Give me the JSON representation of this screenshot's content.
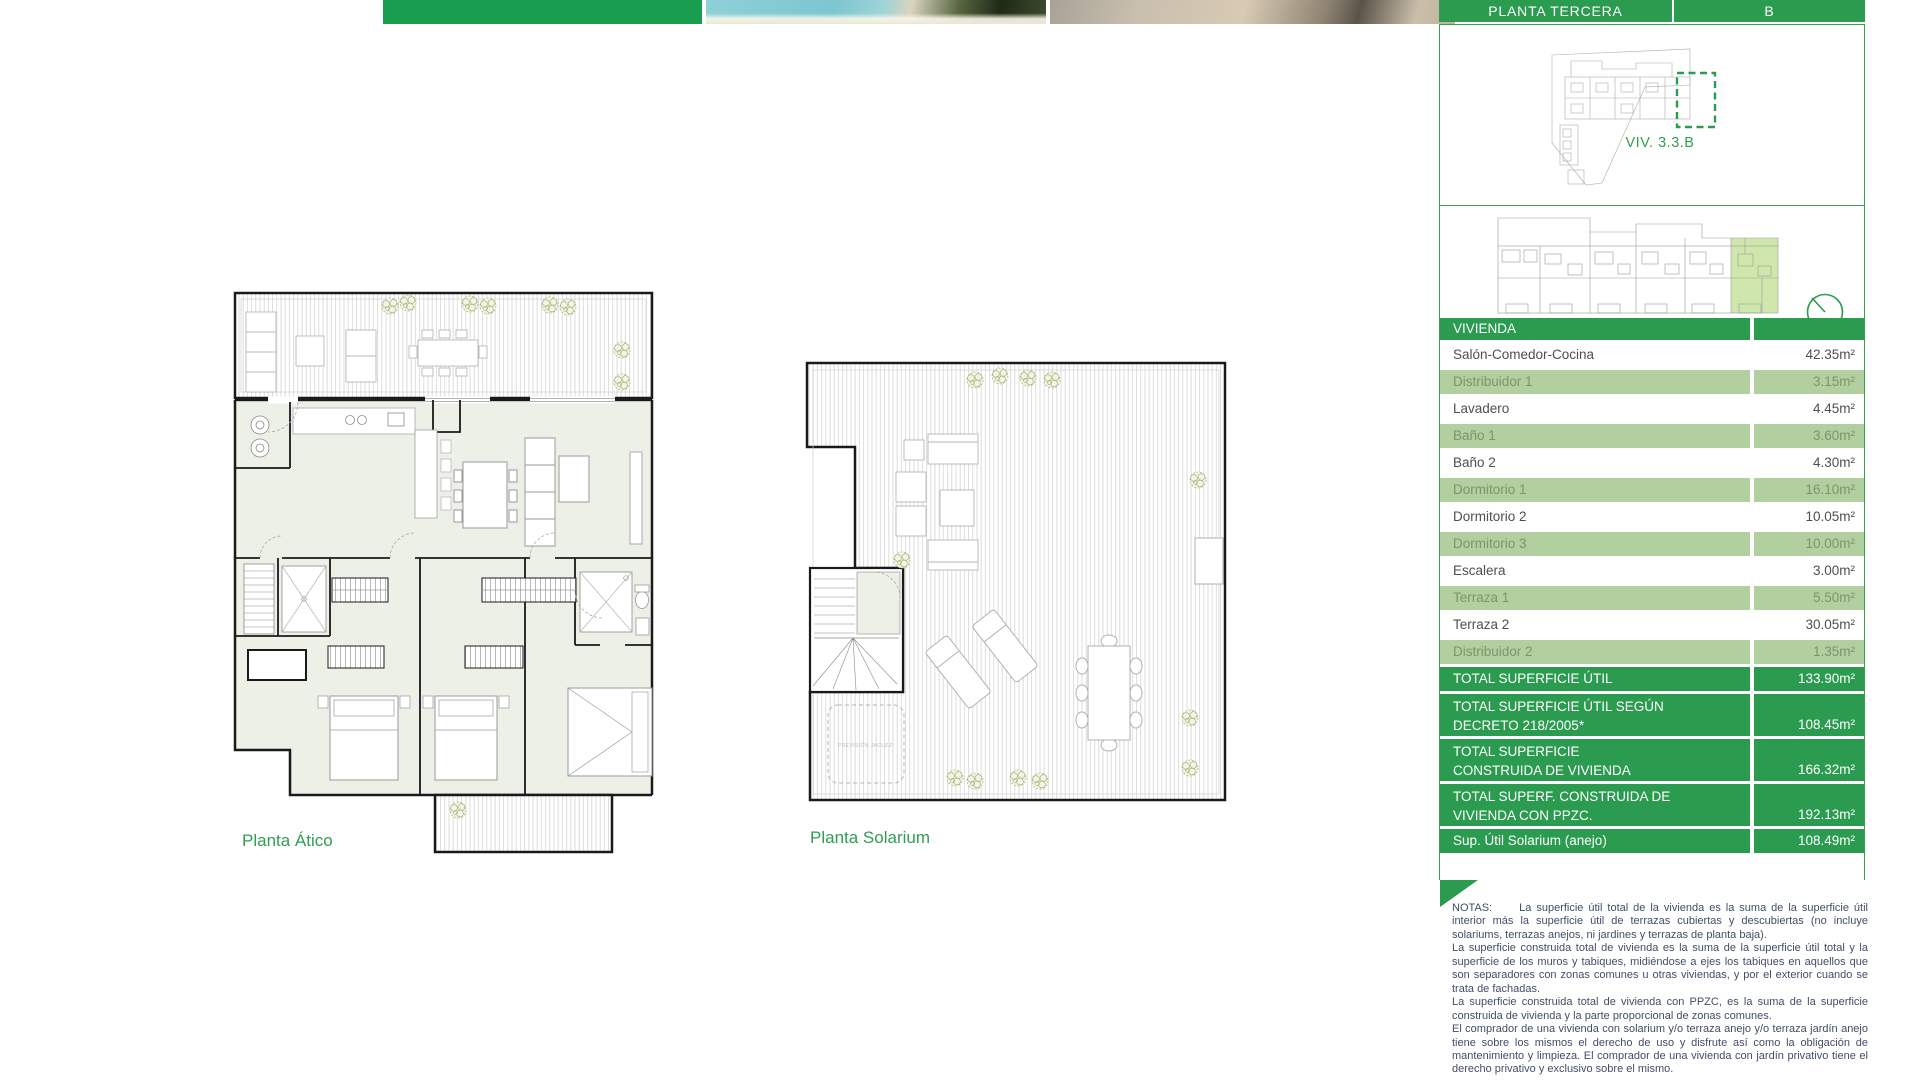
{
  "colors": {
    "brand_green": "#2a9b4f",
    "strip_green_block": "#189e4e",
    "row_light_green": "#b2cfa0",
    "row_text_gray": "#4f4f4f",
    "row_text_green": "#7f9469",
    "panel_border_green": "#3aa054",
    "highlight_unit_green": "#cfe7ad",
    "plan_interior_fill": "#ecf0e7",
    "label_green": "#2f9e52",
    "notes_text": "#414e66"
  },
  "header": {
    "floor_label": "PLANTA TERCERA",
    "unit_label": "B"
  },
  "locator": {
    "unit_caption": "VIV. 3.3.B"
  },
  "plans": [
    {
      "label": "Planta Ático"
    },
    {
      "label": "Planta Solarium",
      "jacuzzi_note": "PREVISIÓN JACUZZI"
    }
  ],
  "area_table": {
    "rows": [
      {
        "label": "VIVIENDA",
        "value": "",
        "variant": "header"
      },
      {
        "label": "Salón-Comedor-Cocina",
        "value": "42.35m²",
        "variant": "white"
      },
      {
        "label": "Distribuidor 1",
        "value": "3.15m²",
        "variant": "light"
      },
      {
        "label": "Lavadero",
        "value": "4.45m²",
        "variant": "white"
      },
      {
        "label": "Baño 1",
        "value": "3.60m²",
        "variant": "light"
      },
      {
        "label": "Baño 2",
        "value": "4.30m²",
        "variant": "white"
      },
      {
        "label": "Dormitorio 1",
        "value": "16.10m²",
        "variant": "light"
      },
      {
        "label": "Dormitorio 2",
        "value": "10.05m²",
        "variant": "white"
      },
      {
        "label": "Dormitorio 3",
        "value": "10.00m²",
        "variant": "light"
      },
      {
        "label": "Escalera",
        "value": "3.00m²",
        "variant": "white"
      },
      {
        "label": "Terraza 1",
        "value": "5.50m²",
        "variant": "light"
      },
      {
        "label": "Terraza 2",
        "value": "30.05m²",
        "variant": "white"
      },
      {
        "label": "Distribuidor 2",
        "value": "1.35m²",
        "variant": "light"
      },
      {
        "label": "TOTAL SUPERFICIE ÚTIL",
        "value": "133.90m²",
        "variant": "total"
      },
      {
        "label": "TOTAL SUPERFICIE ÚTIL SEGÚN\nDECRETO 218/2005*",
        "value": "108.45m²",
        "variant": "total-tall"
      },
      {
        "label": "TOTAL SUPERFICIE\nCONSTRUIDA DE VIVIENDA",
        "value": "166.32m²",
        "variant": "total-tall"
      },
      {
        "label": "TOTAL SUPERF. CONSTRUIDA DE\nVIVIENDA CON PPZC.",
        "value": "192.13m²",
        "variant": "total-tall"
      },
      {
        "label": "Sup. Útil Solarium (anejo)",
        "value": "108.49m²",
        "variant": "total"
      }
    ]
  },
  "notes": {
    "label": "NOTAS:",
    "paragraphs": [
      "La superficie útil total de la vivienda es la suma de la superficie útil interior más la superficie útil de terrazas cubiertas y descubiertas (no incluye solariums, terrazas anejos, ni jardines y terrazas de planta baja).",
      "La superficie construida total de vivienda es la suma de la superficie útil total y la superficie de los muros y tabiques, midiéndose a ejes los tabiques en aquellos que son separadores con zonas comunes u otras viviendas, y por el exterior cuando se trata de fachadas.",
      "La superficie construida total de vivienda con PPZC, es la suma de la superficie construida de vivienda y la parte proporcional de zonas comunes.",
      "El comprador de una vivienda con solarium y/o terraza anejo y/o terraza jardín anejo tiene sobre los mismos el derecho de uso y disfrute así como la obligación de mantenimiento y limpieza. El comprador de una vivienda con jardín privativo tiene el derecho privativo y exclusivo sobre el mismo."
    ]
  }
}
